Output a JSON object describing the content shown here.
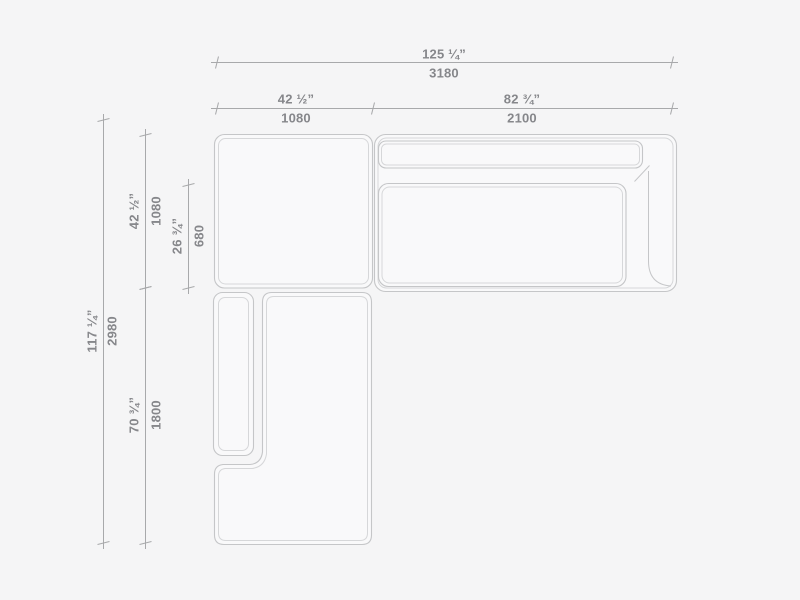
{
  "title": "sectional-sofa-plan-drawing",
  "colors": {
    "bg": "#f5f5f6",
    "fill": "#f9f9fa",
    "outline": "#c5c6c8",
    "outline2": "#d6d7d9",
    "dimline": "#a8a9ab",
    "dimtext": "#86878b"
  },
  "dims": {
    "total_width": {
      "in": "125 ¼”",
      "mm": "3180"
    },
    "left_width": {
      "in": "42 ½”",
      "mm": "1080"
    },
    "right_width": {
      "in": "82 ¾”",
      "mm": "2100"
    },
    "total_depth": {
      "in": "117 ¼”",
      "mm": "2980"
    },
    "corner_depth": {
      "in": "42 ½”",
      "mm": "1080"
    },
    "seat_depth": {
      "in": "26 ¾”",
      "mm": "680"
    },
    "chaise_length": {
      "in": "70 ¾”",
      "mm": "1800"
    }
  }
}
